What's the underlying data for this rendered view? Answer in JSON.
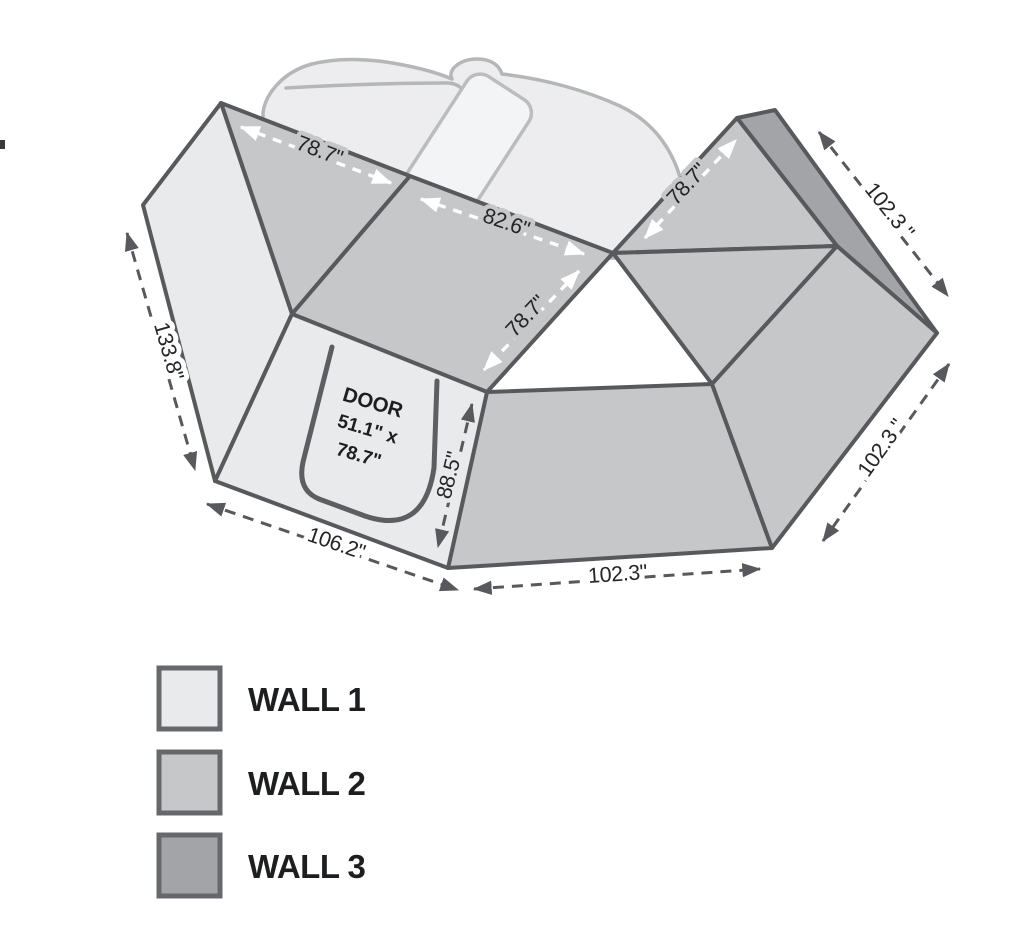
{
  "title": "awning-wall-kit-dimension-diagram",
  "dimensions": {
    "left_wall_slant": "133.8\"",
    "front_bottom_left": "106.2\"",
    "bottom_center": "102.3\"",
    "right_lower_edge": "102.3 \"",
    "right_upper_edge": "102.3 \"",
    "door_panel_height": "88.5\"",
    "roof_edge_left": "78.7\"",
    "roof_edge_center": "82.6\"",
    "roof_seam_center": "78.7\"",
    "roof_edge_right": "78.7\""
  },
  "door": {
    "title": "DOOR",
    "size_line1": "51.1\" x",
    "size_line2": "78.7\""
  },
  "legend": {
    "items": [
      {
        "label": "WALL 1",
        "color": "#e9eaec"
      },
      {
        "label": "WALL 2",
        "color": "#c6c7c9"
      },
      {
        "label": "WALL 3",
        "color": "#a2a4a7"
      }
    ]
  },
  "colors": {
    "wall1": "#e9eaec",
    "wall2": "#c6c7c9",
    "wall3": "#a2a4a7",
    "outline": "#58595d",
    "ghost_vehicle": "#b4b6b9",
    "dimension_text": "#242527"
  }
}
